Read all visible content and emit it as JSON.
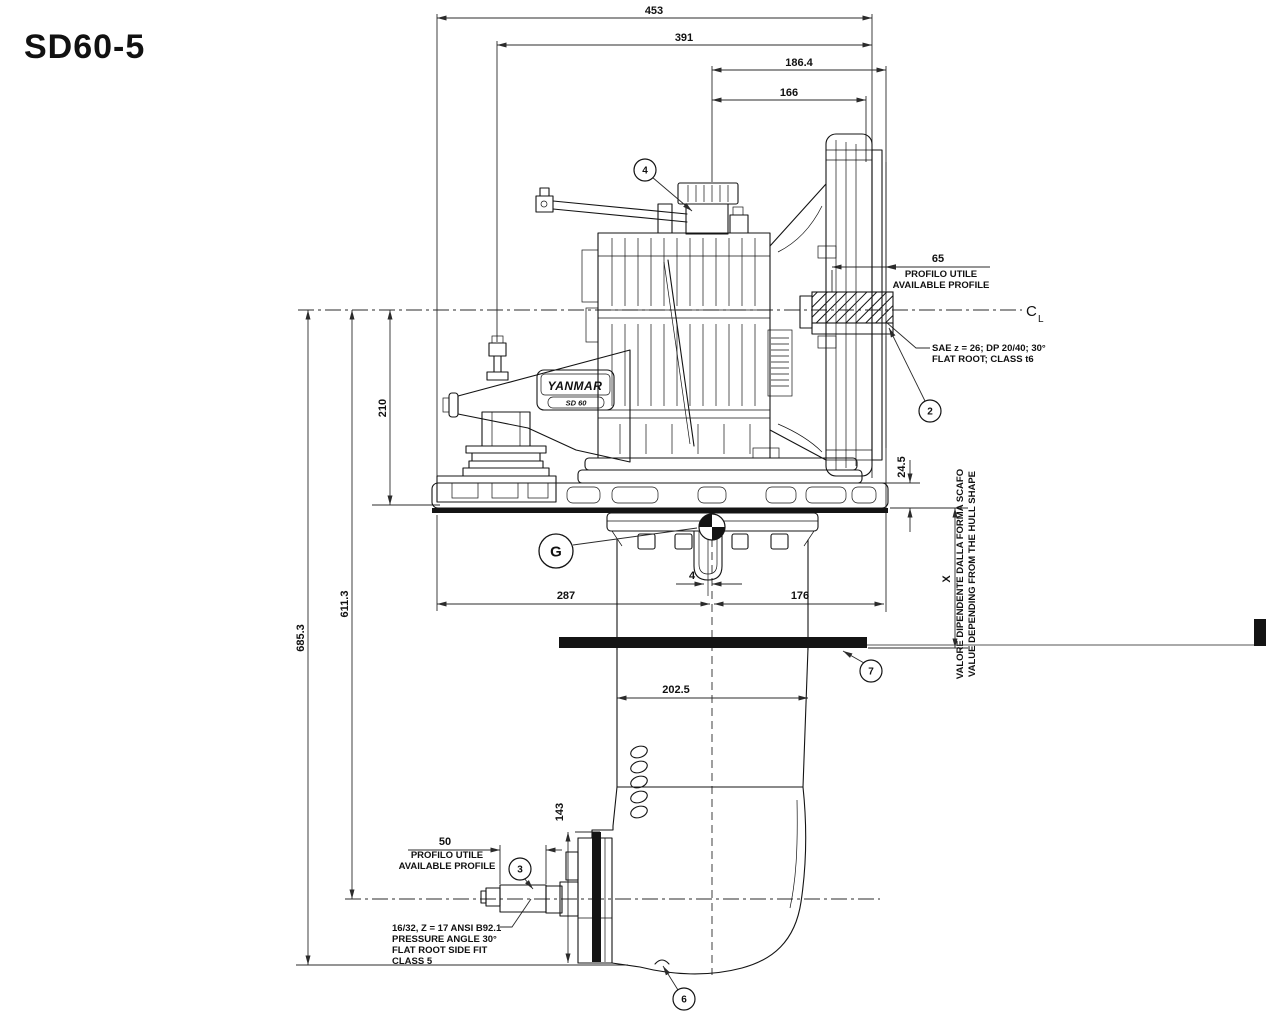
{
  "title": "SD60-5",
  "dims": {
    "d453": "453",
    "d391": "391",
    "d186": "186.4",
    "d166": "166",
    "d210": "210",
    "d611": "611.3",
    "d685": "685.3",
    "d287": "287",
    "d176": "176",
    "d4": "4",
    "d245": "24.5",
    "dX": "X",
    "d202": "202.5",
    "d143": "143",
    "d50": "50",
    "d65": "65"
  },
  "notes": {
    "profile_top": {
      "line1": "PROFILO UTILE",
      "line2": "AVAILABLE PROFILE"
    },
    "profile_bottom": {
      "line1": "PROFILO UTILE",
      "line2": "AVAILABLE PROFILE"
    },
    "sae": {
      "line1": "SAE z = 26;  DP 20/40; 30°",
      "line2": "FLAT ROOT; CLASS t6"
    },
    "spline": {
      "line1": "16/32, Z = 17 ANSI B92.1",
      "line2": "PRESSURE ANGLE 30°",
      "line3": "FLAT ROOT SIDE FIT",
      "line4": "CLASS 5"
    },
    "hull": {
      "line1": "VALORE DIPENDENTE DALLA FORMA SCAFO",
      "line2": "VALUE DEPENDING FROM THE HULL SHAPE"
    },
    "centerline": {
      "c": "C",
      "l": "L"
    }
  },
  "balloons": {
    "b2": "2",
    "b3": "3",
    "b4": "4",
    "b6": "6",
    "b7": "7",
    "g": "G"
  },
  "labels": {
    "brand": "YANMAR",
    "model": "SD 60"
  },
  "colors": {
    "line": "#141414",
    "dim": "#2b2b2b",
    "background": "#ffffff"
  }
}
